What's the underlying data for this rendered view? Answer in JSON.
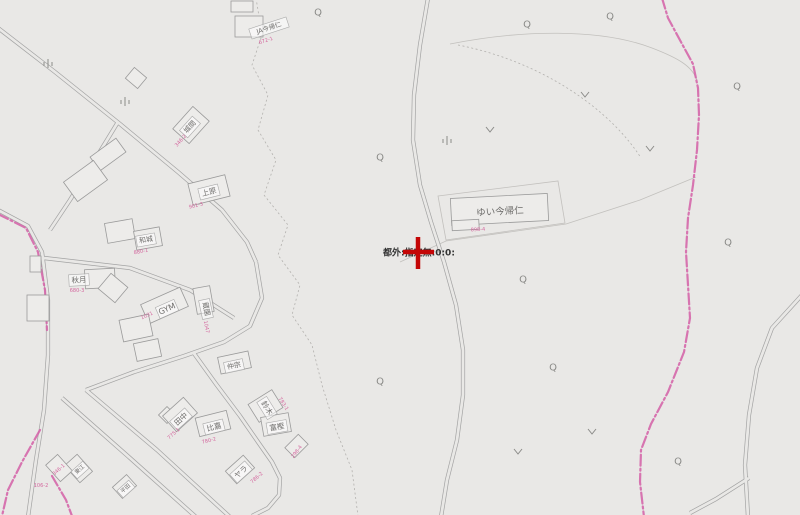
{
  "map": {
    "background": "#e9e8e6",
    "road_color": "#a3a3a3",
    "road_width": 4.2,
    "road_inner_width": 2.8,
    "parcel_color": "#c2c0bd",
    "dashed_color": "#b3b1ae",
    "building_fill": "#edecea",
    "building_stroke": "#9a9a9a",
    "boundary_color": "#d463a8",
    "label_color": "#6f6e6c",
    "label_box_fill": "rgba(255,255,255,0.55)",
    "label_box_stroke": "#a9a9a9",
    "lot_color": "#d4679e",
    "symbol_color": "#8b8b88",
    "roads": [
      "M -2,28 L 55,72 L 120,124 L 178,172 L 222,210 L 247,242 L 256,262",
      "M 118,122 L 96,158 L 70,200 L 50,230",
      "M -2,210 L 28,226 L 42,252 L 48,300 L 48,355 L 44,410 L 36,460 L 28,517",
      "M 256,262 L 262,298 L 250,326 L 224,342 L 184,356 L 134,372 L 86,390",
      "M 44,258 L 130,268 L 190,290 L 234,318",
      "M 62,398 L 130,458 L 196,517",
      "M 86,390 L 157,450 L 230,517",
      "M 193,352 L 216,384 L 240,416 L 258,442 L 272,462 L 280,478 L 279,495 L 268,508 L 252,516",
      "M 428,-2 L 420,45 L 414,95 L 413,140 L 420,185 L 431,222 L 444,262 L 456,305 L 463,350 L 463,395 L 457,440 L 447,480 L 441,517",
      "M 802,295 L 772,328 L 757,368 L 749,415 L 745,465 L 748,517",
      "M 749,478 L 716,499 L 690,513"
    ],
    "parcel_lines": [
      "M 400,262 L 446,241 L 566,224 L 640,200 L 696,177",
      "M 438,196 L 558,181 L 565,223 L 446,240 Z",
      "M 450,44 C 520,30 600,28 652,48 C 678,58 692,66 697,80"
    ],
    "dashed_lines": [
      "M 256,-2 L 262,35 L 252,65 L 268,95 L 258,130 L 276,160 L 264,195 L 288,225 L 278,255 L 300,285 L 292,315 L 312,345 L 322,385 L 336,430 L 352,470 L 358,516",
      "M 458,45 C 545,62 612,112 641,158"
    ],
    "boundaries": [
      "M 662,-2 L 668,18 L 681,42 L 693,64 L 698,88 L 699,115 L 697,150 L 693,185 L 688,218 L 686,252 L 688,285 L 690,318 L 684,352 L 668,392 L 651,424 L 641,450 L 640,482 L 644,517",
      "M -2,214 L 26,228 L 38,252 L 45,290 L 47,330",
      "M 40,430 L 22,462 L 8,490 L 2,516",
      "M 52,476 L 66,500 L 72,516"
    ],
    "buildings": [
      [
        231,
        1,
        22,
        11,
        0
      ],
      [
        235,
        16,
        28,
        21,
        0
      ],
      [
        128,
        71,
        16,
        14,
        40
      ],
      [
        176,
        114,
        30,
        22,
        -48
      ],
      [
        92,
        146,
        32,
        17,
        -36
      ],
      [
        67,
        169,
        37,
        24,
        -36
      ],
      [
        190,
        179,
        38,
        22,
        -14
      ],
      [
        106,
        221,
        28,
        20,
        -10
      ],
      [
        135,
        229,
        26,
        19,
        -10
      ],
      [
        85,
        269,
        30,
        19,
        -3
      ],
      [
        102,
        278,
        22,
        20,
        40
      ],
      [
        195,
        287,
        17,
        26,
        -10
      ],
      [
        143,
        295,
        43,
        21,
        -24
      ],
      [
        27,
        295,
        22,
        26,
        0
      ],
      [
        121,
        317,
        30,
        22,
        -12
      ],
      [
        30,
        256,
        11,
        16,
        0
      ],
      [
        219,
        354,
        31,
        17,
        -12
      ],
      [
        161,
        409,
        12,
        12,
        45
      ],
      [
        166,
        404,
        28,
        21,
        -42
      ],
      [
        197,
        414,
        32,
        19,
        -14
      ],
      [
        255,
        392,
        21,
        28,
        58
      ],
      [
        262,
        415,
        28,
        19,
        -10
      ],
      [
        228,
        461,
        24,
        17,
        -42
      ],
      [
        70,
        457,
        17,
        23,
        -42
      ],
      [
        115,
        479,
        19,
        15,
        -42
      ],
      [
        287,
        439,
        19,
        14,
        -45
      ],
      [
        51,
        457,
        16,
        22,
        -42
      ],
      [
        135,
        341,
        25,
        18,
        -12
      ],
      [
        451,
        196,
        97,
        27,
        -3
      ],
      [
        452,
        220,
        27,
        10,
        -3
      ]
    ],
    "name_labels": [
      {
        "text": "JA今帰仁",
        "x": 269,
        "y": 28,
        "rot": -18,
        "size": 6.5,
        "boxed": true
      },
      {
        "text": "城間",
        "x": 190,
        "y": 127,
        "rot": -48,
        "size": 7,
        "boxed": true
      },
      {
        "text": "上原",
        "x": 209,
        "y": 192,
        "rot": -14,
        "size": 7.5,
        "boxed": true
      },
      {
        "text": "和城",
        "x": 146,
        "y": 240,
        "rot": -10,
        "size": 7,
        "boxed": true
      },
      {
        "text": "秋月",
        "x": 79,
        "y": 280,
        "rot": -3,
        "size": 7.5,
        "boxed": true
      },
      {
        "text": "GYM",
        "x": 167,
        "y": 309,
        "rot": -24,
        "size": 8,
        "boxed": true
      },
      {
        "text": "蔵園",
        "x": 206,
        "y": 309,
        "rot": 78,
        "size": 7,
        "boxed": true
      },
      {
        "text": "仲宗",
        "x": 234,
        "y": 366,
        "rot": -12,
        "size": 7,
        "boxed": true
      },
      {
        "text": "田中",
        "x": 181,
        "y": 419,
        "rot": -42,
        "size": 7.5,
        "boxed": true
      },
      {
        "text": "比嘉",
        "x": 214,
        "y": 427,
        "rot": -14,
        "size": 7.5,
        "boxed": true
      },
      {
        "text": "鈴木",
        "x": 267,
        "y": 408,
        "rot": 58,
        "size": 7.5,
        "boxed": true
      },
      {
        "text": "富樫",
        "x": 277,
        "y": 427,
        "rot": -10,
        "size": 7.5,
        "boxed": true
      },
      {
        "text": "ヤラ",
        "x": 241,
        "y": 472,
        "rot": -42,
        "size": 7.5,
        "boxed": true
      },
      {
        "text": "東江",
        "x": 80,
        "y": 470,
        "rot": -42,
        "size": 5.5,
        "boxed": true
      },
      {
        "text": "平田",
        "x": 126,
        "y": 489,
        "rot": -42,
        "size": 5.5,
        "boxed": true
      },
      {
        "text": "ゆい今帰仁",
        "x": 500,
        "y": 212,
        "rot": -3,
        "size": 9.5,
        "boxed": false
      }
    ],
    "lot_labels": [
      {
        "text": "672-1",
        "x": 266,
        "y": 41,
        "rot": -18
      },
      {
        "text": "346-2",
        "x": 181,
        "y": 141,
        "rot": -48
      },
      {
        "text": "901-3",
        "x": 196,
        "y": 206,
        "rot": -14
      },
      {
        "text": "880-1",
        "x": 141,
        "y": 252,
        "rot": -10
      },
      {
        "text": "680-3",
        "x": 77,
        "y": 291,
        "rot": 0
      },
      {
        "text": "1031",
        "x": 147,
        "y": 316,
        "rot": -24
      },
      {
        "text": "1047",
        "x": 206,
        "y": 327,
        "rot": 78
      },
      {
        "text": "898-4",
        "x": 478,
        "y": 230,
        "rot": -3
      },
      {
        "text": "775-1",
        "x": 174,
        "y": 434,
        "rot": -42
      },
      {
        "text": "780-2",
        "x": 209,
        "y": 441,
        "rot": -14
      },
      {
        "text": "783-1",
        "x": 283,
        "y": 404,
        "rot": 58
      },
      {
        "text": "298-4",
        "x": 297,
        "y": 452,
        "rot": -52
      },
      {
        "text": "786-2",
        "x": 257,
        "y": 478,
        "rot": -42
      },
      {
        "text": "346-1",
        "x": 59,
        "y": 470,
        "rot": -42
      },
      {
        "text": "106-2",
        "x": 41,
        "y": 486,
        "rot": 0
      }
    ],
    "symbols": {
      "q": [
        [
          318,
          13
        ],
        [
          527,
          25
        ],
        [
          610,
          17
        ],
        [
          737,
          87
        ],
        [
          380,
          158
        ],
        [
          523,
          280
        ],
        [
          553,
          368
        ],
        [
          380,
          382
        ],
        [
          678,
          462
        ],
        [
          728,
          243
        ]
      ],
      "v": [
        [
          585,
          95
        ],
        [
          490,
          130
        ],
        [
          650,
          149
        ],
        [
          518,
          452
        ],
        [
          592,
          432
        ]
      ],
      "wasteland": [
        [
          48,
          66
        ],
        [
          125,
          104
        ],
        [
          447,
          143
        ]
      ]
    }
  },
  "marker": {
    "x": 418,
    "y": 252,
    "label": "都外:指定無:0:0:",
    "cross_color": "#c40606",
    "label_color": "#333333"
  }
}
